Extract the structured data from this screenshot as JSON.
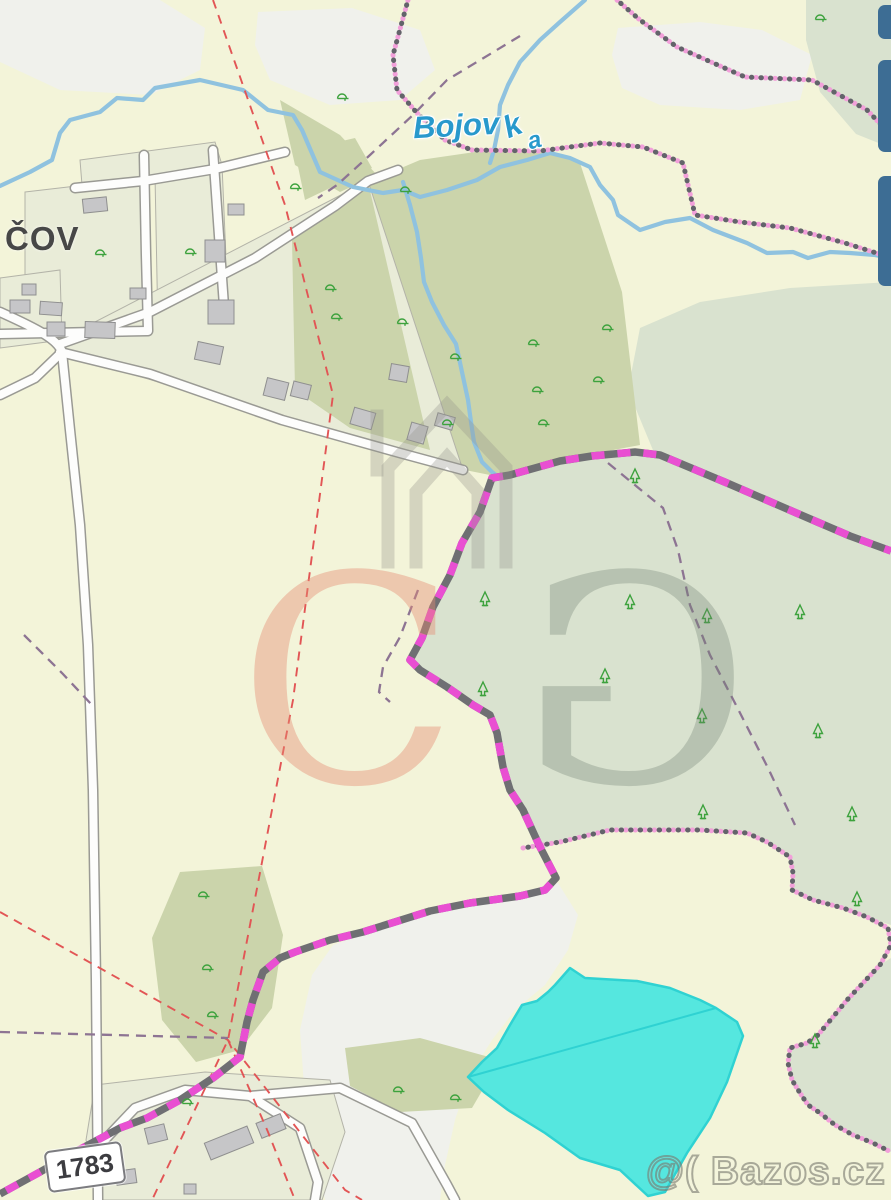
{
  "map": {
    "village_label": "ČOV",
    "stream_label": {
      "part1": "Bojov",
      "part2": "k",
      "part3": "a"
    },
    "road_badge": "1783",
    "watermark_site": "@( Bazos.cz",
    "watermark_logo": {
      "left_letter": "C",
      "right_letter": "G"
    }
  },
  "colors": {
    "background": "#f3f4d9",
    "white_patch": "#f0f1ec",
    "parcel": "#e9ecd8",
    "parcel_line": "#b3b3a8",
    "olive": "#cbd4ab",
    "sage": "#d9e2cf",
    "road": "#fdfdfc",
    "road_casing": "#9a9a94",
    "building": "#c6c6c8",
    "building_line": "#8f8f8f",
    "stream": "#8fc2df",
    "pond": "#55e7df",
    "pond_line": "#2fd2d2",
    "red_line": "#e25555",
    "purple_line": "#8d7493",
    "pink_dot": "#f2a0da",
    "dark_dot": "#63636a",
    "boundary_gray": "#6f6f73",
    "boundary_magenta": "#e94fd2",
    "tree": "#3da23d",
    "label_blue": "#2899cc",
    "label_dark": "#474747",
    "ui_blue": "#3d6d94"
  }
}
